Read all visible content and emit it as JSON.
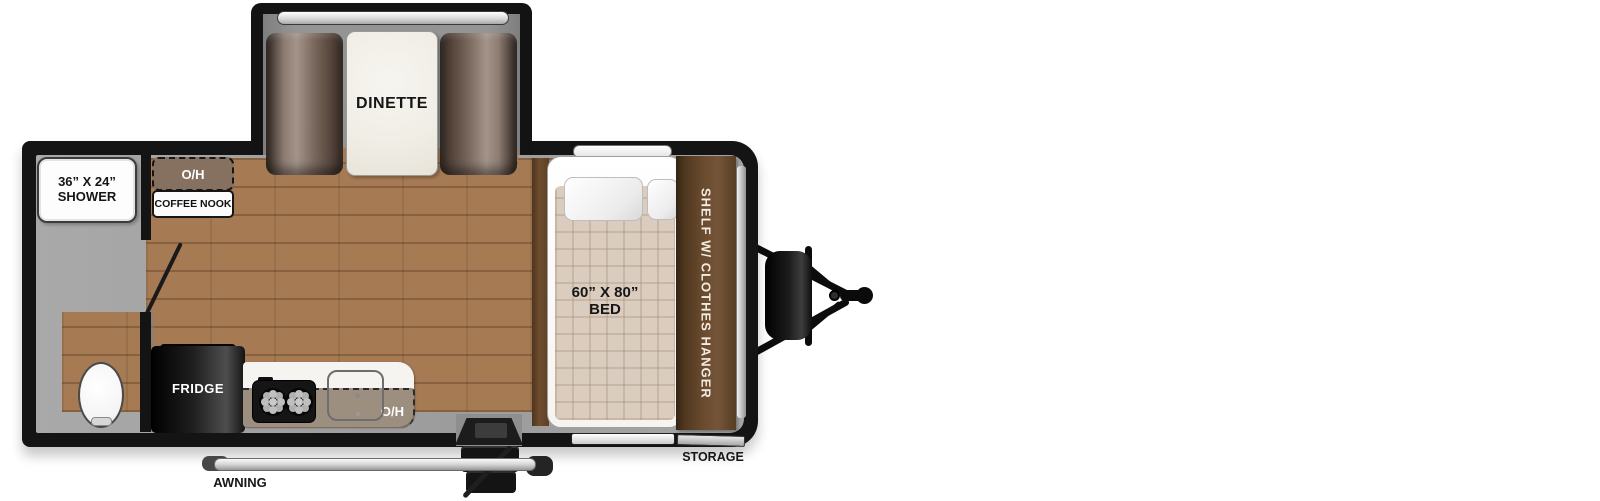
{
  "floorplan": {
    "slideout": {
      "dinette_label": "DINETTE"
    },
    "bathroom": {
      "shower_line1": "36” X 24”",
      "shower_line2": "SHOWER"
    },
    "coffee_nook": {
      "oh_label": "O/H",
      "label": "COFFEE NOOK"
    },
    "kitchen": {
      "fridge_label": "FRIDGE",
      "oh_label": "O/H"
    },
    "bedroom": {
      "bed_line1": "60” X 80”",
      "bed_line2": "BED",
      "shelf_label": "SHELF W/ CLOTHES HANGER"
    },
    "exterior": {
      "awning_label": "AWNING",
      "storage_label": "STORAGE"
    }
  },
  "colors": {
    "wall_black": "#141414",
    "floor_brown": "#a67b54",
    "bathroom_gray": "#9e9e9e",
    "bench_brown": "#6b594e",
    "shelf_brown": "#5d4229",
    "table_white": "#f2f0ea",
    "trim_silver": "#d9d9d9"
  }
}
